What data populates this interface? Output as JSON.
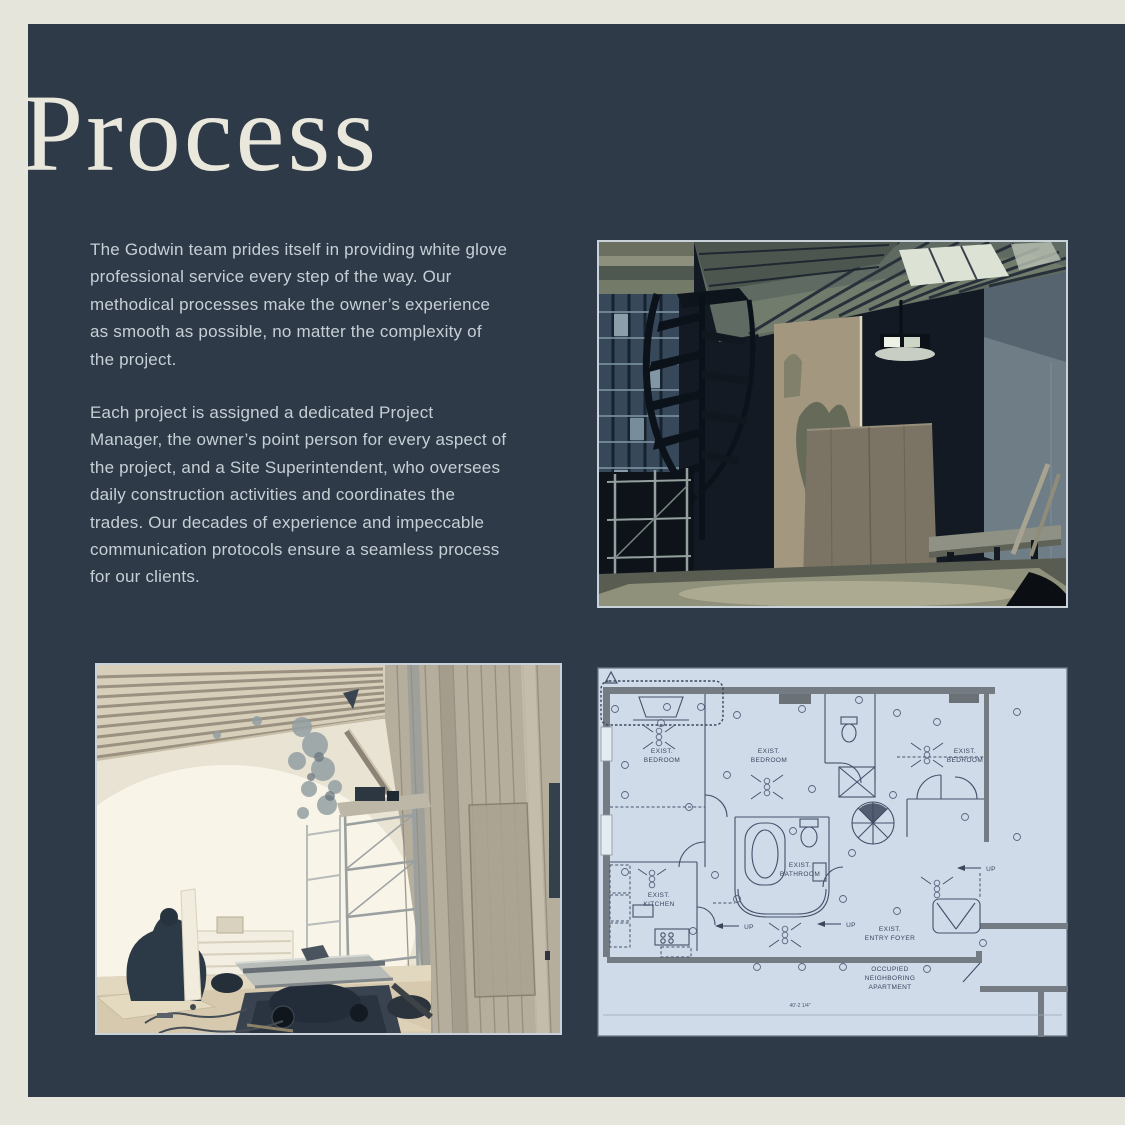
{
  "page": {
    "title": "Process",
    "paragraphs": [
      "The Godwin team prides itself in providing white glove professional service every step of the way. Our methodical processes make the owner’s experience as smooth as possible, no matter the complexity of the project.",
      "Each project is assigned a dedicated Project Manager, the owner’s point person for every aspect of the project, and a Site Superintendent, who oversees daily construction activities and coordinates the trades. Our decades of experience and impeccable communication protocols ensure a seamless process for our clients."
    ]
  },
  "colors": {
    "canvas_bg": "#e5e5dc",
    "page_bg": "#2e3a47",
    "heading_text": "#eae8dd",
    "body_text": "#c6cfd6",
    "photo_border": "#c9d2d8",
    "plan_bg": "#cfdbe8",
    "plan_wall": "#747b83",
    "plan_line": "#44506a"
  },
  "floor_plan": {
    "labels": {
      "bedroom": {
        "l1": "EXIST.",
        "l2": "BEDROOM"
      },
      "bathroom": {
        "l1": "EXIST.",
        "l2": "BATHROOM"
      },
      "kitchen": {
        "l1": "EXIST.",
        "l2": "KITCHEN"
      },
      "entry_foyer": {
        "l1": "EXIST.",
        "l2": "ENTRY FOYER"
      },
      "occupied": {
        "l1": "OCCUPIED",
        "l2": "NEIGHBORING",
        "l3": "APARTMENT"
      }
    },
    "up_label": "UP",
    "dimension": "40'-2 1/4\""
  }
}
